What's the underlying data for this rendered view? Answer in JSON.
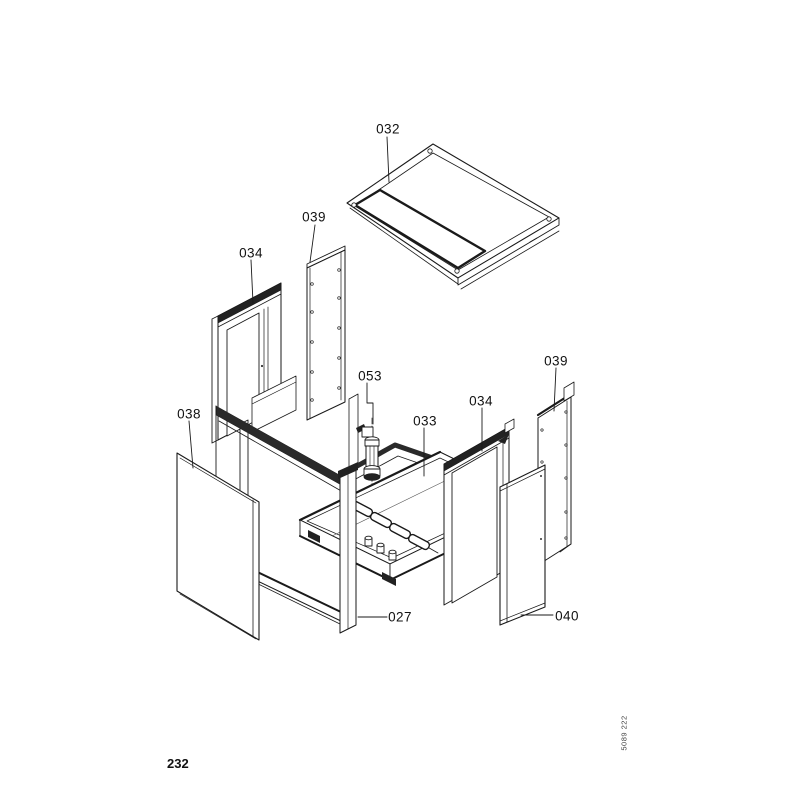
{
  "page": {
    "number": "232",
    "doc_code": "5089 222"
  },
  "diagram": {
    "type": "exploded-parts-diagram",
    "labels": [
      {
        "part": "top-cover",
        "text": "032"
      },
      {
        "part": "side-panel-rear-left",
        "text": "039"
      },
      {
        "part": "frame-left",
        "text": "034"
      },
      {
        "part": "front-panel-left",
        "text": "038"
      },
      {
        "part": "valve-assembly",
        "text": "053"
      },
      {
        "part": "base-assembly",
        "text": "033"
      },
      {
        "part": "frame-right",
        "text": "034"
      },
      {
        "part": "side-panel-rear-right",
        "text": "039"
      },
      {
        "part": "casing-body",
        "text": "027"
      },
      {
        "part": "front-panel-right",
        "text": "040"
      }
    ]
  }
}
